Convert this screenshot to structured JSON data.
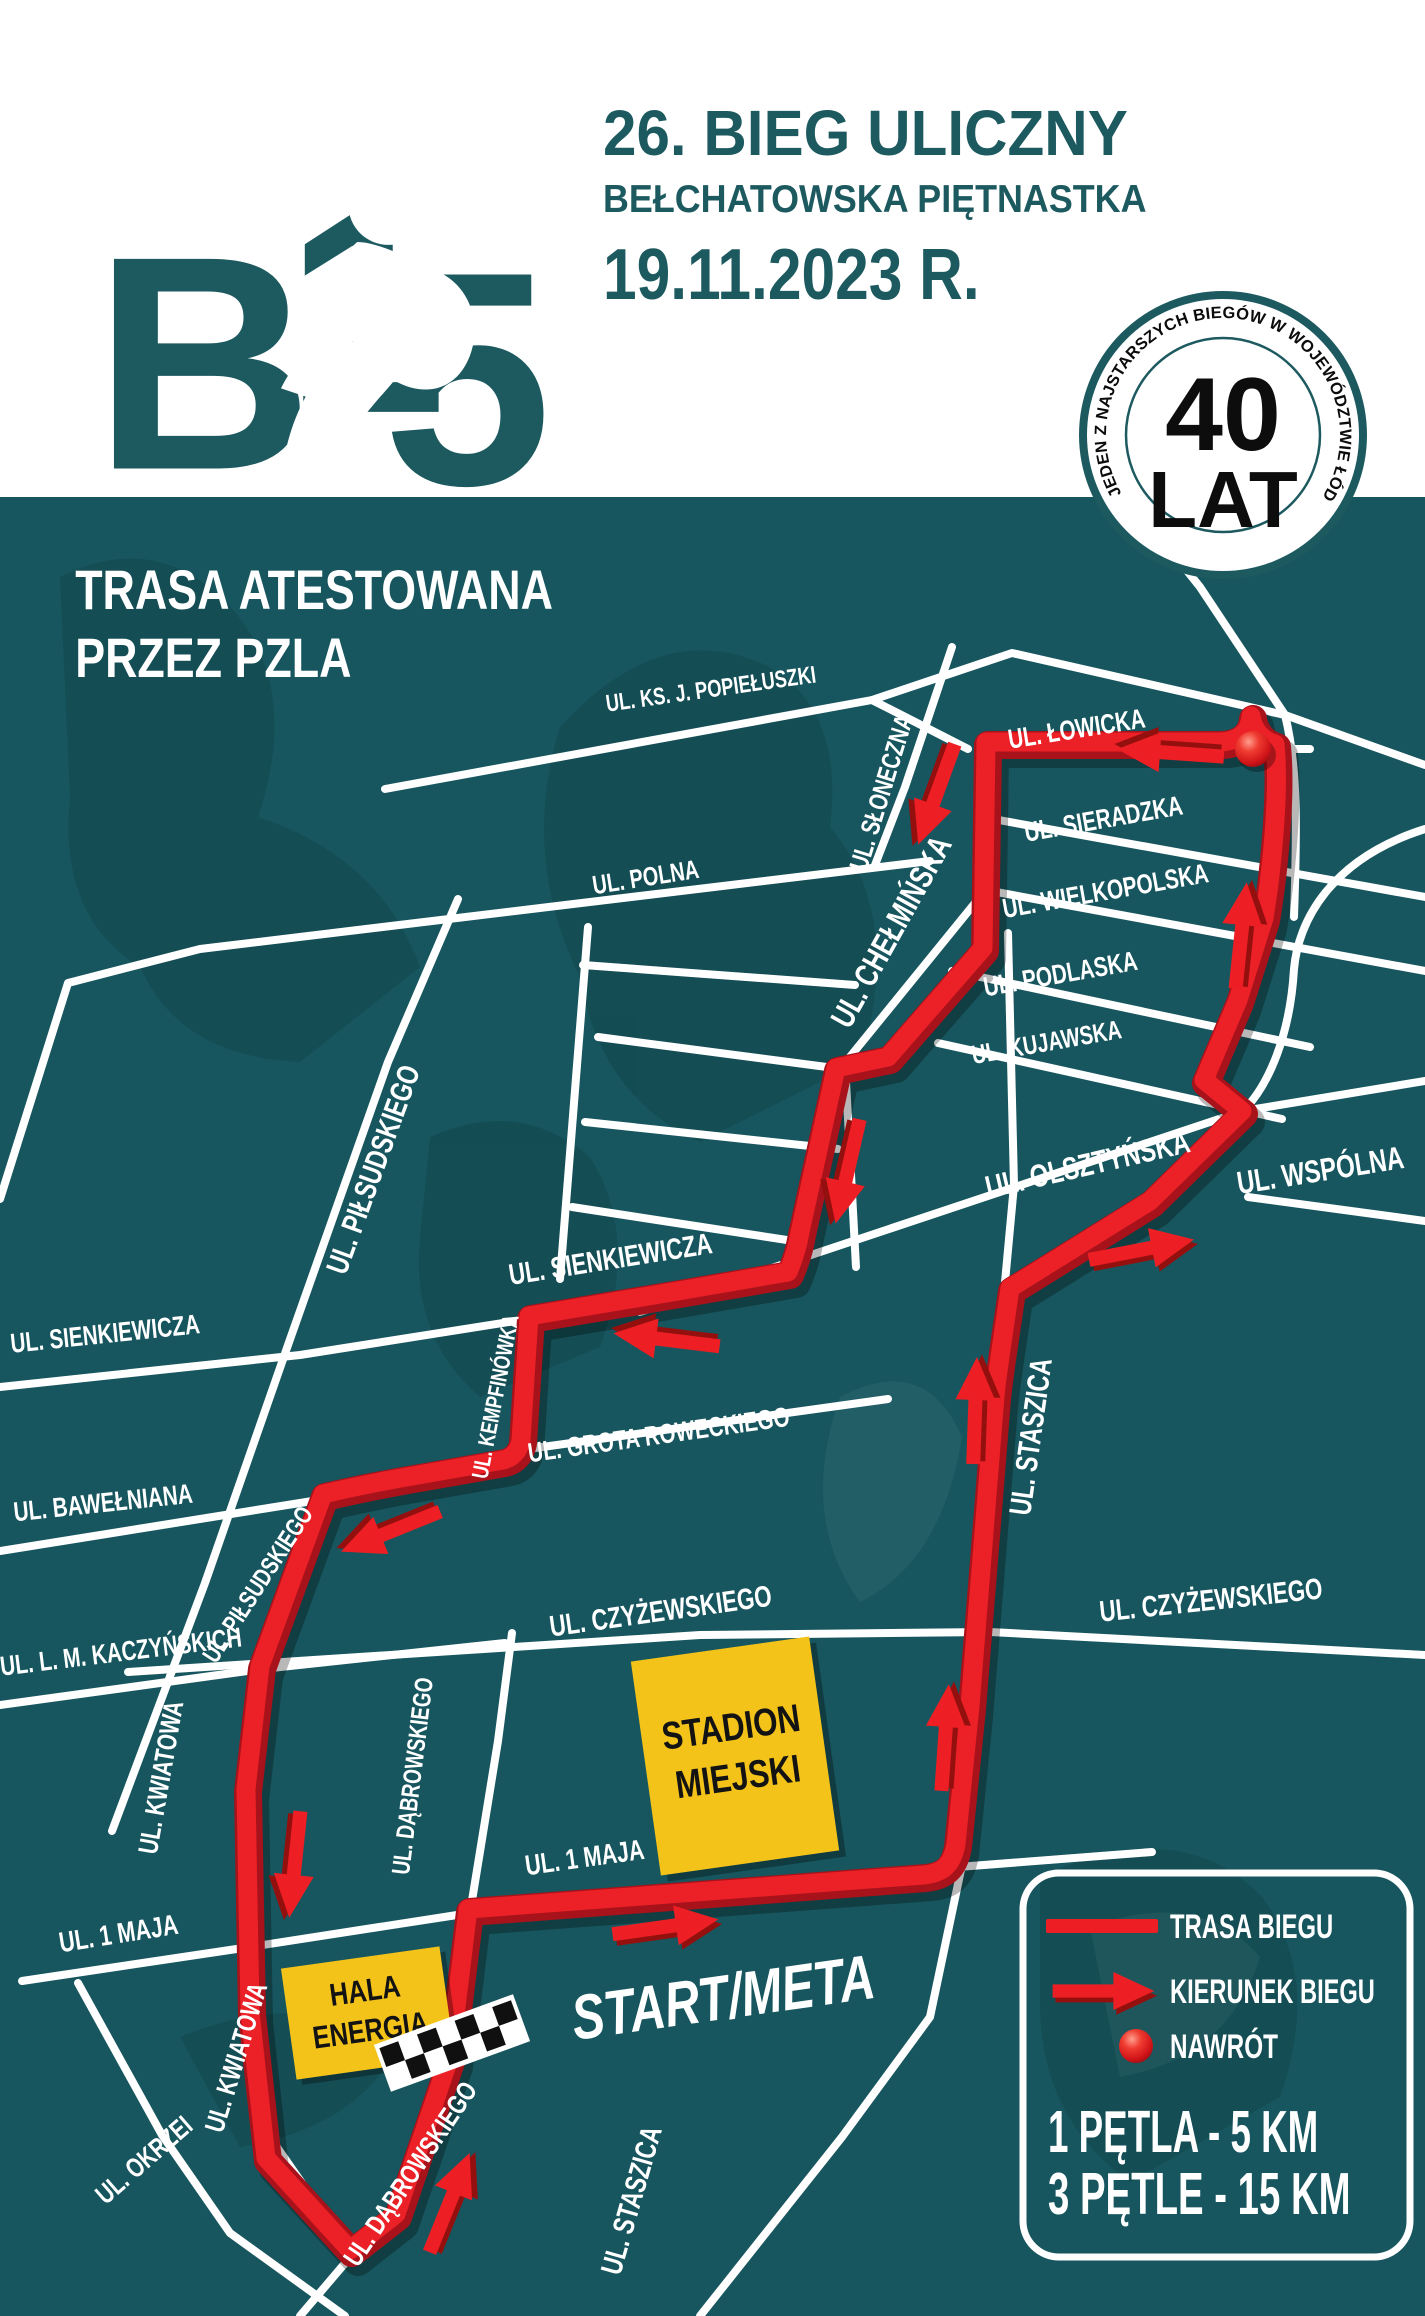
{
  "header": {
    "logo": {
      "b": "B",
      "one": "1",
      "five": "5"
    },
    "title": "26. BIEG ULICZNY",
    "subtitle": "BEŁCHATOWSKA PIĘTNASTKA",
    "date": "19.11.2023 R."
  },
  "badge": {
    "ring_text": "JEDEN Z NAJSTARSZYCH BIEGÓW W WOJEWÓDZTWIE ŁÓDZKIM",
    "big": "40",
    "small": "LAT"
  },
  "map": {
    "certification": {
      "line1": "TRASA ATESTOWANA",
      "line2": "PRZEZ PZLA"
    },
    "start_finish": "START/META",
    "buildings": {
      "stadium": {
        "line1": "STADION",
        "line2": "MIEJSKI"
      },
      "hall": {
        "line1": "HALA",
        "line2": "ENERGIA"
      }
    },
    "streets": [
      {
        "id": "popieluszki",
        "label": "UL. KS. J. POPIEŁUSZKI"
      },
      {
        "id": "lowicka",
        "label": "UL. ŁOWICKA"
      },
      {
        "id": "sloneczna",
        "label": "UL. SŁONECZNA"
      },
      {
        "id": "sieradzka",
        "label": "UL. SIERADZKA"
      },
      {
        "id": "wielkopolska",
        "label": "UL. WIELKOPOLSKA"
      },
      {
        "id": "podlaska",
        "label": "UL. PODLASKA"
      },
      {
        "id": "kujawska",
        "label": "UL. KUJAWSKA"
      },
      {
        "id": "chelminska",
        "label": "UL. CHEŁMIŃSKA"
      },
      {
        "id": "polna",
        "label": "UL. POLNA"
      },
      {
        "id": "olsztynska",
        "label": "UL. OLSZTYŃSKA"
      },
      {
        "id": "wspolna",
        "label": "UL. WSPÓLNA"
      },
      {
        "id": "pilsudskiego-upper",
        "label": "UL. PIŁSUDSKIEGO"
      },
      {
        "id": "sienkiewicza-mid",
        "label": "UL. SIENKIEWICZA"
      },
      {
        "id": "sienkiewicza-left",
        "label": "UL. SIENKIEWICZA"
      },
      {
        "id": "kempfinowka",
        "label": "UL. KEMPFINÓWKA"
      },
      {
        "id": "grota-roweckiego",
        "label": "UL. GROTA ROWECKIEGO"
      },
      {
        "id": "bawelniana",
        "label": "UL. BAWEŁNIANA"
      },
      {
        "id": "pilsudskiego-lower",
        "label": "UL. PIŁSUDSKIEGO"
      },
      {
        "id": "staszica-mid",
        "label": "UL. STASZICA"
      },
      {
        "id": "czyzewskiego-left",
        "label": "UL. CZYŻEWSKIEGO"
      },
      {
        "id": "czyzewskiego-right",
        "label": "UL. CZYŻEWSKIEGO"
      },
      {
        "id": "kaczynskich",
        "label": "UL. L. M. KACZYŃSKICH"
      },
      {
        "id": "kwiatowa-upper",
        "label": "UL. KWIATOWA"
      },
      {
        "id": "dabrowskiego-upper",
        "label": "UL. DĄBROWSKIEGO"
      },
      {
        "id": "1maja-left",
        "label": "UL. 1 MAJA"
      },
      {
        "id": "1maja-right",
        "label": "UL. 1 MAJA"
      },
      {
        "id": "kwiatowa-lower",
        "label": "UL. KWIATOWA"
      },
      {
        "id": "okrzei",
        "label": "UL. OKRZEI"
      },
      {
        "id": "dabrowskiego-lower",
        "label": "UL. DĄBROWSKIEGO"
      },
      {
        "id": "staszica-lower",
        "label": "UL. STASZICA"
      }
    ]
  },
  "legend": {
    "route": "TRASA BIEGU",
    "direction": "KIERUNEK BIEGU",
    "turnaround": "NAWRÓT",
    "loop1": "1 PĘTLA - 5 KM",
    "loop3": "3 PĘTLE - 15 KM"
  },
  "colors": {
    "teal": "#1D5A60",
    "map_background": "#17565E",
    "route_red": "#EC2027",
    "route_red_dark": "#A8121A",
    "arrow_red": "#EE1F24",
    "building_yellow": "#F4C31A"
  }
}
